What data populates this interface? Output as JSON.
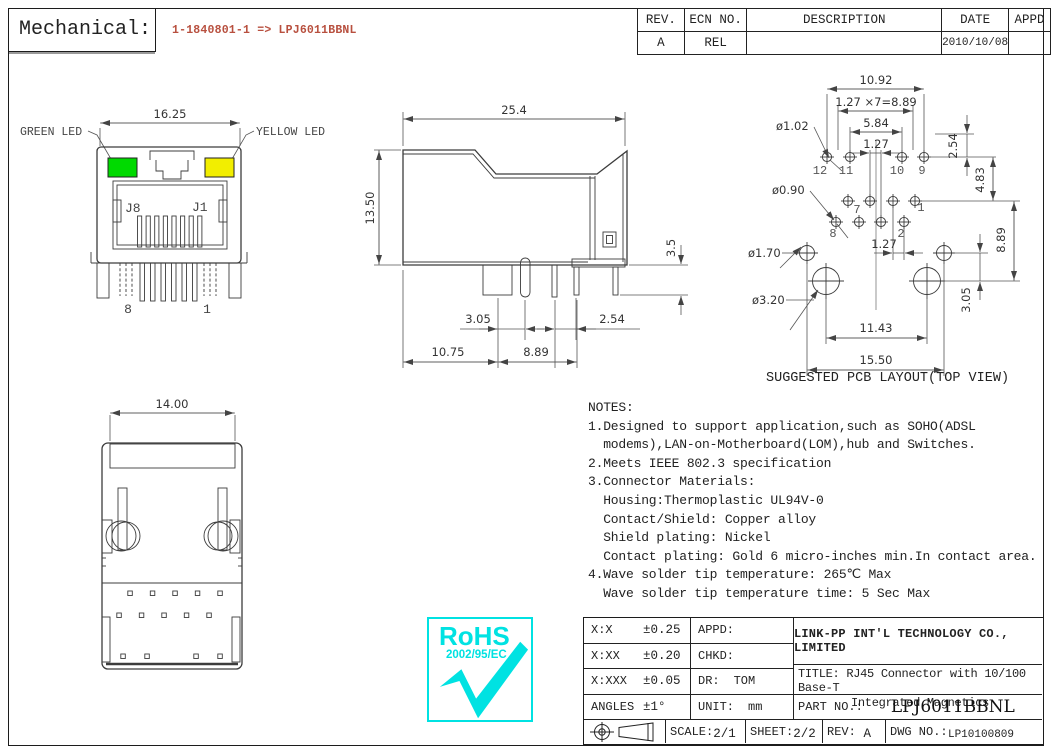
{
  "header": {
    "section_label": "Mechanical:",
    "part_mapping": "1-1840801-1 => LPJ6011BBNL",
    "accent_color": "#b8503f"
  },
  "revision_table": {
    "col_rev": "REV.",
    "col_ecn": "ECN NO.",
    "col_desc": "DESCRIPTION",
    "col_date": "DATE",
    "col_appd": "APPD",
    "row": {
      "rev": "A",
      "ecn": "REL",
      "desc": "",
      "date": "2010/10/08",
      "appd": ""
    }
  },
  "front_view": {
    "green_led_label": "GREEN LED",
    "yellow_led_label": "YELLOW LED",
    "dim_width": "16.25",
    "jack_label_j8": "J8",
    "jack_label_j1": "J1",
    "pin_label_8": "8",
    "pin_label_1": "1",
    "green_color": "#00da00",
    "yellow_color": "#f2ee00"
  },
  "side_view": {
    "dim_width": "25.4",
    "dim_height": "13.50",
    "dim_pin_length": "3.5",
    "dim_post_offset": "3.05",
    "dim_pin_pitch": "2.54",
    "dim_front": "10.75",
    "dim_rear": "8.89"
  },
  "bottom_view": {
    "dim_width": "14.00"
  },
  "pcb_layout": {
    "caption": "SUGGESTED PCB LAYOUT(TOP VIEW)",
    "dim_overall_width": "10.92",
    "dim_pitch_total": "1.27 ×7=8.89",
    "dim_inner_span": "5.84",
    "dim_pitch": "1.27",
    "dim_row_offset": "2.54",
    "dim_row_spacing": "4.83",
    "dim_post_row": "8.89",
    "dim_post_offset": "3.05",
    "dim_pitch_lower": "1.27",
    "dim_big_hole_span": "11.43",
    "dim_small_hole_span": "15.50",
    "hole_dia_signal": "ø1.02",
    "hole_dia_signal2": "ø0.90",
    "hole_dia_small_post": "ø1.70",
    "hole_dia_big_post": "ø3.20",
    "pins": {
      "p12": "12",
      "p11": "11",
      "p10": "10",
      "p9": "9",
      "p7": "7",
      "p1": "1",
      "p8": "8",
      "p2": "2"
    }
  },
  "notes": {
    "lines": [
      "NOTES:",
      "1.Designed to support application,such as SOHO(ADSL",
      "  modems),LAN-on-Motherboard(LOM),hub and Switches.",
      "2.Meets IEEE 802.3 specification",
      "3.Connector Materials:",
      "  Housing:Thermoplastic UL94V-0",
      "  Contact/Shield: Copper alloy",
      "  Shield plating: Nickel",
      "  Contact plating: Gold 6 micro-inches min.In contact area.",
      "4.Wave solder tip temperature: 265℃ Max",
      "  Wave solder tip temperature time: 5 Sec Max"
    ]
  },
  "rohs": {
    "title": "RoHS",
    "directive": "2002/95/EC",
    "color": "#00e2e2"
  },
  "title_block": {
    "tol_rows": [
      {
        "label": "X:X",
        "value": "±0.25"
      },
      {
        "label": "X:XX",
        "value": "±0.20"
      },
      {
        "label": "X:XXX",
        "value": "±0.05"
      },
      {
        "label": "ANGLES",
        "value": "±1°"
      }
    ],
    "appd_label": "APPD:",
    "appd_value": "",
    "chkd_label": "CHKD:",
    "chkd_value": "",
    "dr_label": "DR:",
    "dr_value": "TOM",
    "unit_label": "UNIT:",
    "unit_value": "mm",
    "company": "LINK-PP INT'L TECHNOLOGY CO., LIMITED",
    "title_label": "TITLE:",
    "title_line1": "RJ45 Connector with 10/100 Base-T",
    "title_line2": "Integrated Magnetics",
    "part_no_label": "PART NO.:",
    "part_no": "LPJ6011BBNL",
    "scale_label": "SCALE:",
    "scale_value": "2/1",
    "sheet_label": "SHEET:",
    "sheet_value": "2/2",
    "rev_label": "REV:",
    "rev_value": "A",
    "dwg_label": "DWG NO.:",
    "dwg_value": "LP10100809"
  }
}
